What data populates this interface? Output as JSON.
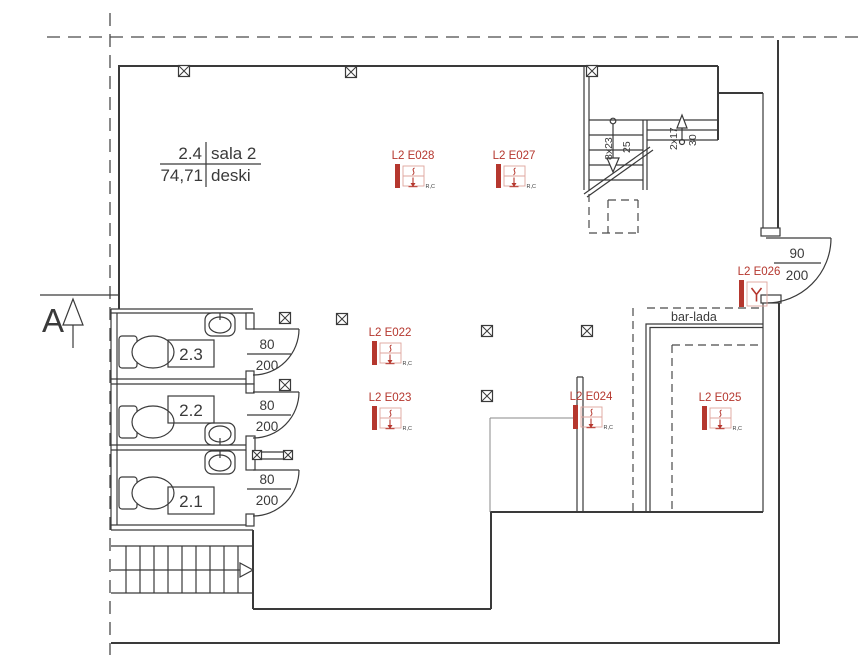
{
  "colors": {
    "accent_red": "#b5372e",
    "line": "#3a3a3a",
    "symbol_box_pink": "#dfa49d"
  },
  "section": {
    "label": "A"
  },
  "main_room": {
    "number": "2.4",
    "name": "sala 2",
    "area": "74,71",
    "finish": "deski"
  },
  "rooms": [
    {
      "number": "2.3"
    },
    {
      "number": "2.2"
    },
    {
      "number": "2.1"
    }
  ],
  "bar": {
    "label": "bar-lada"
  },
  "stairs": {
    "down_count": "8x23",
    "down_width": "25",
    "up_count": "2x17",
    "up_width": "30"
  },
  "doors": [
    {
      "id": "door-wc-2.3",
      "width": "80",
      "height": "200"
    },
    {
      "id": "door-wc-2.2",
      "width": "80",
      "height": "200"
    },
    {
      "id": "door-wc-2.1",
      "width": "80",
      "height": "200"
    },
    {
      "id": "door-main",
      "width": "90",
      "height": "200"
    }
  ],
  "fixtures": [
    {
      "id": "L2 E028",
      "x": 395,
      "y": 164,
      "type": "ceiling",
      "note": "R,C"
    },
    {
      "id": "L2 E027",
      "x": 496,
      "y": 164,
      "type": "ceiling",
      "note": "R,C"
    },
    {
      "id": "L2 E022",
      "x": 372,
      "y": 341,
      "type": "ceiling",
      "note": "R,C"
    },
    {
      "id": "L2 E023",
      "x": 372,
      "y": 406,
      "type": "ceiling",
      "note": "R,C"
    },
    {
      "id": "L2 E024",
      "x": 573,
      "y": 405,
      "type": "ceiling",
      "note": "R,C"
    },
    {
      "id": "L2 E025",
      "x": 702,
      "y": 406,
      "type": "ceiling",
      "note": "R,C"
    },
    {
      "id": "L2 E026",
      "x": 739,
      "y": 280,
      "type": "wall",
      "note": ""
    }
  ],
  "junction_boxes": [
    {
      "x": 184,
      "y": 71
    },
    {
      "x": 351,
      "y": 72
    },
    {
      "x": 592,
      "y": 71
    },
    {
      "x": 285,
      "y": 318
    },
    {
      "x": 342,
      "y": 319
    },
    {
      "x": 487,
      "y": 331
    },
    {
      "x": 587,
      "y": 331
    },
    {
      "x": 285,
      "y": 385
    },
    {
      "x": 487,
      "y": 396
    },
    {
      "x": 257,
      "y": 455,
      "s": 9
    },
    {
      "x": 288,
      "y": 455,
      "s": 9
    }
  ]
}
